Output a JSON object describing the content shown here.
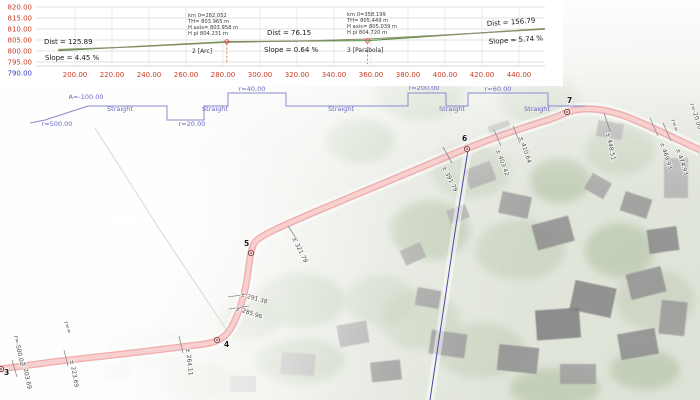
{
  "app": {
    "title": "Road design CAD viewport"
  },
  "chart_data": {
    "type": "line",
    "title": "Vertical profile (longitudinal section)",
    "xlabel": "Station (m)",
    "ylabel": "Elevation (m)",
    "x_ticks": [
      "200.00",
      "220.00",
      "240.00",
      "260.00",
      "280.00",
      "300.00",
      "320.00",
      "340.00",
      "360.00",
      "380.00",
      "400.00",
      "420.00",
      "440.00"
    ],
    "y_ticks": [
      "820.00",
      "815.00",
      "810.00",
      "805.00",
      "800.00",
      "795.00",
      "790.00"
    ],
    "y_tick_values": [
      820,
      815,
      810,
      805,
      800,
      795,
      790
    ],
    "x_tick_values": [
      200,
      220,
      240,
      260,
      280,
      300,
      320,
      340,
      360,
      380,
      400,
      420,
      440
    ],
    "xlim": [
      191,
      454
    ],
    "ylim": [
      790,
      820
    ],
    "grid": true,
    "series": [
      {
        "name": "design-grade-line",
        "color": "#5a8f3c",
        "points": [
          [
            191,
            800.18
          ],
          [
            282.052,
            804.231
          ],
          [
            358.199,
            804.72
          ],
          [
            454,
            810.22
          ]
        ]
      },
      {
        "name": "terrain-line",
        "color": "#8f8f72",
        "points": [
          [
            191,
            800.7
          ],
          [
            230,
            801.8
          ],
          [
            282.052,
            803.965
          ],
          [
            320,
            804.5
          ],
          [
            358.199,
            805.449
          ],
          [
            400,
            807.3
          ],
          [
            454,
            809.9
          ]
        ]
      }
    ],
    "segment_labels": [
      {
        "dist": "Dist = 125.89",
        "slope": "Slope = 4.45 %"
      },
      {
        "dist": "Dist = 76.15",
        "slope": "Slope = 0.64 %"
      },
      {
        "dist": "Dist = 156.79",
        "slope": "Slope = 5.74 %"
      }
    ],
    "vertex_annotations": [
      {
        "name": "2 [Arc]",
        "station": 282.052,
        "elev": 804.231,
        "lines": [
          "km 0=282.052",
          "TH= 803.965 m",
          "H axis= 803.958 m",
          "H pl 804.231 m"
        ]
      },
      {
        "name": "3 [Parabola]",
        "station": 358.199,
        "elev": 804.72,
        "lines": [
          "km 0=358.199",
          "TH= 805.449 m",
          "H axis= 805.039 m",
          "H pl 804.720 m"
        ]
      }
    ],
    "axis_color": "#c93b25",
    "min_tick_color": "#3a3ac8"
  },
  "alignment_band": {
    "color": "#6868c4",
    "labels": [
      {
        "text": "A=-100.00",
        "x": 86,
        "y": 99,
        "anchor": "middle"
      },
      {
        "text": "Straight",
        "x": 120,
        "y": 111,
        "anchor": "middle"
      },
      {
        "text": "r=500.00",
        "x": 57,
        "y": 126,
        "anchor": "middle"
      },
      {
        "text": "r=20.00",
        "x": 192,
        "y": 126,
        "anchor": "middle"
      },
      {
        "text": "Straight",
        "x": 215,
        "y": 111,
        "anchor": "middle"
      },
      {
        "text": "r=40.00",
        "x": 252,
        "y": 91,
        "anchor": "middle"
      },
      {
        "text": "Straight",
        "x": 341,
        "y": 111,
        "anchor": "middle"
      },
      {
        "text": "r=200.00",
        "x": 424,
        "y": 90,
        "anchor": "middle"
      },
      {
        "text": "Straight",
        "x": 452,
        "y": 111,
        "anchor": "middle"
      },
      {
        "text": "r=60.00",
        "x": 498,
        "y": 91,
        "anchor": "middle"
      },
      {
        "text": "Straight",
        "x": 537,
        "y": 111,
        "anchor": "middle"
      }
    ],
    "polyline": [
      [
        30,
        123
      ],
      [
        45,
        120
      ],
      [
        88,
        106
      ],
      [
        167,
        106
      ],
      [
        167,
        120
      ],
      [
        204,
        120
      ],
      [
        204,
        106
      ],
      [
        228,
        106
      ],
      [
        228,
        93
      ],
      [
        286,
        93
      ],
      [
        286,
        106
      ],
      [
        408,
        106
      ],
      [
        408,
        93
      ],
      [
        446,
        93
      ],
      [
        446,
        106
      ],
      [
        468,
        106
      ],
      [
        468,
        93
      ],
      [
        548,
        93
      ],
      [
        548,
        106
      ],
      [
        585,
        106
      ]
    ]
  },
  "map": {
    "points": [
      {
        "label": "3",
        "lx": 4,
        "ly": 375,
        "mx": 1,
        "my": 369
      },
      {
        "label": "4",
        "lx": 224,
        "ly": 347,
        "mx": 217,
        "my": 340
      },
      {
        "label": "5",
        "lx": 244,
        "ly": 246,
        "mx": 251,
        "my": 253
      },
      {
        "label": "6",
        "lx": 462,
        "ly": 141,
        "mx": 467,
        "my": 149
      },
      {
        "label": "7",
        "lx": 567,
        "ly": 103,
        "mx": 567,
        "my": 112
      }
    ],
    "station_labels": [
      {
        "text": "r=-500.00",
        "x": 14,
        "y": 336,
        "rot": 78
      },
      {
        "text": "± 203.69",
        "x": 22,
        "y": 362,
        "rot": 78
      },
      {
        "text": "± 223.69",
        "x": 70,
        "y": 360,
        "rot": 80
      },
      {
        "text": "r=∞",
        "x": 64,
        "y": 322,
        "rot": 72
      },
      {
        "text": "± 264.11",
        "x": 186,
        "y": 348,
        "rot": 84
      },
      {
        "text": "± 285.96",
        "x": 235,
        "y": 310,
        "rot": 18
      },
      {
        "text": "± 291.38",
        "x": 240,
        "y": 296,
        "rot": 16
      },
      {
        "text": "± 321.79",
        "x": 292,
        "y": 238,
        "rot": 64
      },
      {
        "text": "± 391.79",
        "x": 442,
        "y": 167,
        "rot": 64
      },
      {
        "text": "± 403.42",
        "x": 496,
        "y": 150,
        "rot": 70
      },
      {
        "text": "± 410.64",
        "x": 519,
        "y": 137,
        "rot": 72
      },
      {
        "text": "± 448.51",
        "x": 606,
        "y": 133,
        "rot": 78
      },
      {
        "text": "r=∞",
        "x": 671,
        "y": 120,
        "rot": 72
      },
      {
        "text": "± 469.93",
        "x": 660,
        "y": 143,
        "rot": 72
      },
      {
        "text": "r=-20.00",
        "x": 690,
        "y": 104,
        "rot": 72
      },
      {
        "text": "± 474.93",
        "x": 676,
        "y": 149,
        "rot": 72
      }
    ],
    "ticks": [
      [
        12,
        360,
        17,
        377
      ],
      [
        64,
        350,
        68,
        366
      ],
      [
        179,
        336,
        183,
        353
      ],
      [
        228,
        297,
        248,
        294
      ],
      [
        229,
        309,
        249,
        306
      ],
      [
        288,
        226,
        298,
        241
      ],
      [
        443,
        147,
        452,
        163
      ],
      [
        494,
        130,
        501,
        146
      ],
      [
        513,
        126,
        520,
        143
      ],
      [
        604,
        113,
        610,
        131
      ],
      [
        650,
        118,
        658,
        136
      ],
      [
        663,
        123,
        671,
        141
      ]
    ],
    "road_path": "M 0 369 L 60 361 L 140 352 L 205 344 C 218 342 226 337 231 328 C 240 312 246 290 248 272 C 250 258 251 246 256 241 C 262 235 280 227 310 214 C 360 193 420 168 458 152 C 492 138 525 127 548 120 C 560 116 566 112 575 110 C 592 107 612 111 630 118 C 652 127 676 139 700 150",
    "blue_line": [
      [
        468,
        150
      ],
      [
        455,
        232
      ],
      [
        430,
        400
      ]
    ],
    "boundary_line": [
      [
        95,
        128
      ],
      [
        160,
        230
      ],
      [
        228,
        332
      ]
    ],
    "road_edge_color": "#ec9c9c",
    "road_fill_color": "#f8d2d2",
    "survey_line_color": "#4a4aa8",
    "tick_color": "#8a8a8a",
    "label_color": "#4a4a4a"
  }
}
